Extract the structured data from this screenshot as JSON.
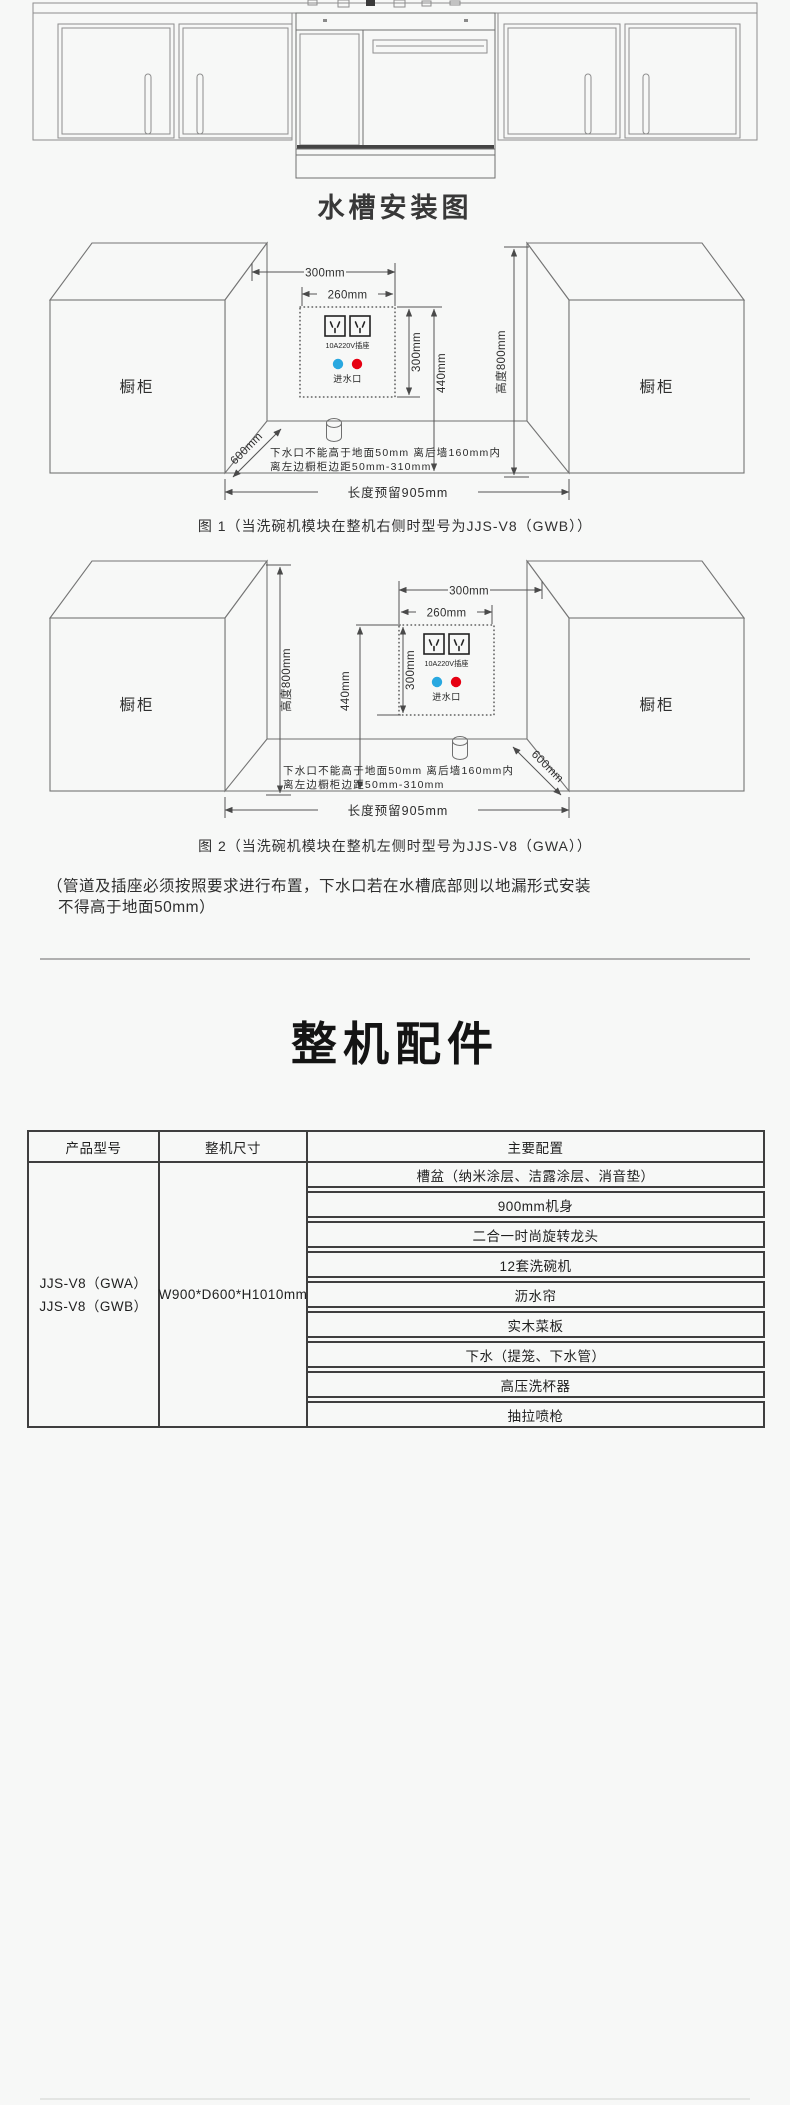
{
  "page": {
    "background": "#f7f8f7"
  },
  "sink_install": {
    "title": "水槽安装图",
    "labels": {
      "cabinet": "橱柜",
      "socket": "10A220V插座",
      "inlet": "进水口",
      "floor_note_line1": "下水口不能高于地面50mm 离后墙160mm内",
      "floor_note_line2": "离左边橱柜边距50mm-310mm"
    },
    "dims": {
      "width_outer": "300mm",
      "width_inner": "260mm",
      "height_inner": "300mm",
      "height_outer": "440mm",
      "cabinet_height": "高度800mm",
      "depth": "600mm",
      "reserved_length": "长度预留905mm"
    },
    "fig1_caption": "图 1（当洗碗机模块在整机右侧时型号为JJS-V8（GWB））",
    "fig2_caption": "图 2（当洗碗机模块在整机左侧时型号为JJS-V8（GWA））",
    "note_line1": "（管道及插座必须按照要求进行布置，下水口若在水槽底部则以地漏形式安装",
    "note_line2": "不得高于地面50mm）",
    "colors": {
      "cold_inlet": "#29a8e0",
      "hot_inlet": "#e60012"
    }
  },
  "accessories": {
    "title": "整机配件",
    "table": {
      "headers": [
        "产品型号",
        "整机尺寸",
        "主要配置"
      ],
      "models": [
        "JJS-V8（GWA）",
        "JJS-V8（GWB）"
      ],
      "size": "W900*D600*H1010mm",
      "configs": [
        "槽盆（纳米涂层、洁露涂层、消音垫）",
        "900mm机身",
        "二合一时尚旋转龙头",
        "12套洗碗机",
        "沥水帘",
        "实木菜板",
        "下水（提笼、下水管）",
        "高压洗杯器",
        "抽拉喷枪"
      ]
    }
  }
}
